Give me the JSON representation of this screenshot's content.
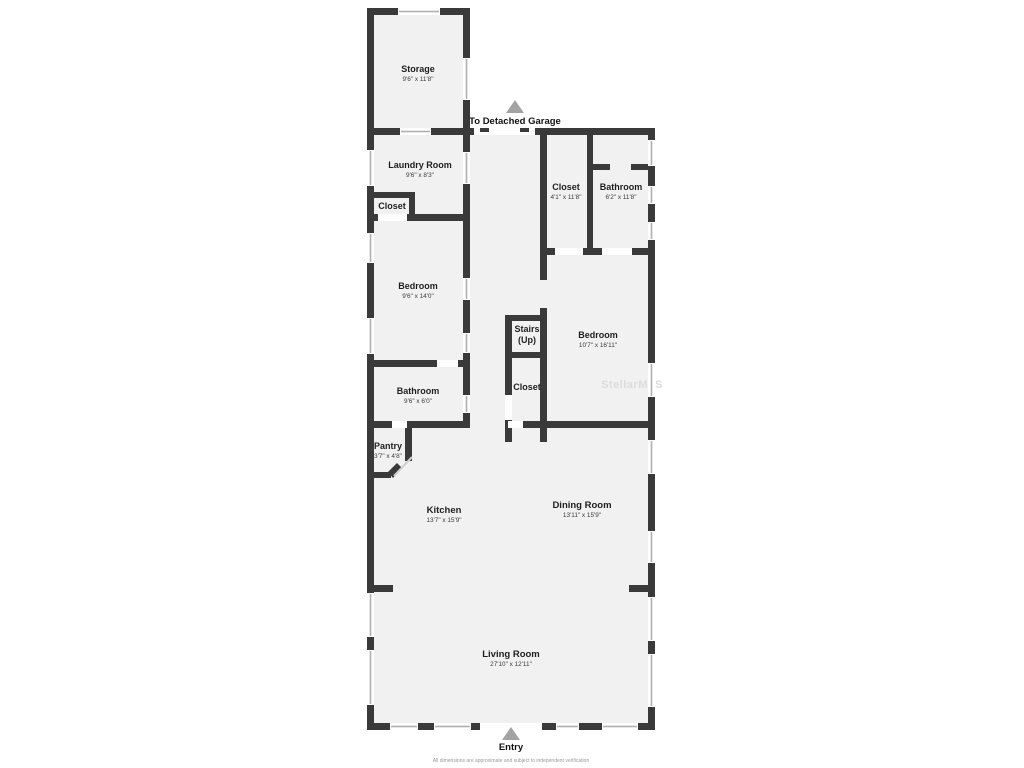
{
  "title": "Floor Plan",
  "colors": {
    "wall": "#3a3a3a",
    "room_fill": "#f1f1f1",
    "background": "#ffffff",
    "window_line": "#b0b0b0",
    "arrow": "#a3a3a3",
    "watermark": "#dcdcdc"
  },
  "annotations": {
    "to_detached_garage": "To Detached Garage",
    "entry": "Entry",
    "watermark": "StellarMLS",
    "disclaimer": "All dimensions are approximate and subject to independent verification"
  },
  "icons": {
    "garage_arrow": "up-triangle",
    "entry_arrow": "up-triangle"
  },
  "rooms": [
    {
      "name": "Storage",
      "dims": "9'6\" x 11'8\""
    },
    {
      "name": "Laundry Room",
      "dims": "9'6\" x 8'3\""
    },
    {
      "name": "Closet",
      "dims": ""
    },
    {
      "name": "Closet",
      "dims": "4'1\" x 11'8\""
    },
    {
      "name": "Bathroom",
      "dims": "6'2\" x 11'8\""
    },
    {
      "name": "Bedroom",
      "dims": "9'6\" x 14'0\""
    },
    {
      "name": "Stairs",
      "sub": "(Up)",
      "dims": ""
    },
    {
      "name": "Bedroom",
      "dims": "10'7\" x 16'11\""
    },
    {
      "name": "Closet",
      "dims": ""
    },
    {
      "name": "Bathroom",
      "dims": "9'6\" x 6'0\""
    },
    {
      "name": "Pantry",
      "dims": "3'7\" x 4'8\""
    },
    {
      "name": "Kitchen",
      "dims": "13'7\" x 15'9\""
    },
    {
      "name": "Dining Room",
      "dims": "13'11\" x 15'9\""
    },
    {
      "name": "Living Room",
      "dims": "27'10\" x 12'11\""
    }
  ]
}
